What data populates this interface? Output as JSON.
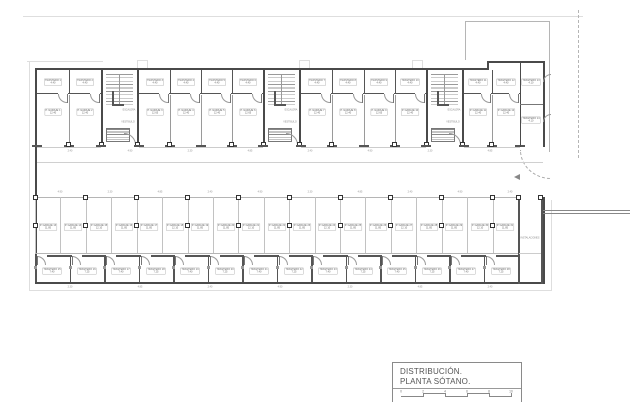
{
  "title_block": {
    "line1": "DISTRIBUCIÓN.",
    "line2": "PLANTA SÓTANO.",
    "scale_ticks": [
      "0",
      "2",
      "4",
      "6",
      "8",
      "10"
    ]
  },
  "core_labels": {
    "escalera": "ESCALERA",
    "vestibulo": "VESTIBULO"
  },
  "instalaciones_label": "INSTALACIONES",
  "rooms": {
    "top_trasteros": [
      {
        "name": "TRASTERO 1",
        "area": "4.40"
      },
      {
        "name": "TRASTERO 2",
        "area": "4.40"
      },
      {
        "name": "TRASTERO 3",
        "area": "4.40"
      },
      {
        "name": "TRASTERO 4",
        "area": "4.40"
      },
      {
        "name": "TRASTERO 5",
        "area": "4.40"
      },
      {
        "name": "TRASTERO 6",
        "area": "4.40"
      },
      {
        "name": "TRASTERO 7",
        "area": "4.40"
      },
      {
        "name": "TRASTERO 8",
        "area": "4.40"
      },
      {
        "name": "TRASTERO 9",
        "area": "4.40"
      },
      {
        "name": "TRASTERO 10",
        "area": "4.40"
      },
      {
        "name": "TRASTERO 11",
        "area": "4.40"
      },
      {
        "name": "TRASTERO 12",
        "area": "4.40"
      }
    ],
    "top_garajes": [
      {
        "name": "P. GARAJE 1",
        "area": "12.40"
      },
      {
        "name": "P. GARAJE 2",
        "area": "12.40"
      },
      {
        "name": "P. GARAJE 3",
        "area": "12.65"
      },
      {
        "name": "P. GARAJE 4",
        "area": "12.40"
      },
      {
        "name": "P. GARAJE 5",
        "area": "12.40"
      },
      {
        "name": "P. GARAJE 6",
        "area": "12.65"
      },
      {
        "name": "P. GARAJE 7",
        "area": "12.40"
      },
      {
        "name": "P. GARAJE 8",
        "area": "12.40"
      },
      {
        "name": "P. GARAJE 9",
        "area": "12.65"
      },
      {
        "name": "P. GARAJE 10",
        "area": "12.40"
      },
      {
        "name": "P. GARAJE 11",
        "area": "12.40"
      },
      {
        "name": "P. GARAJE 12",
        "area": "12.40"
      }
    ],
    "side_trasteros": [
      {
        "name": "TRASTERO 13",
        "area": "4.10"
      },
      {
        "name": "TRASTERO 14",
        "area": "4.10"
      }
    ],
    "parking": [
      {
        "name": "P. GARAJE 13",
        "area": "11.85"
      },
      {
        "name": "P. GARAJE 14",
        "area": "11.85"
      },
      {
        "name": "P. GARAJE 15",
        "area": "12.10"
      },
      {
        "name": "P. GARAJE 16",
        "area": "11.85"
      },
      {
        "name": "P. GARAJE 17",
        "area": "11.85"
      },
      {
        "name": "P. GARAJE 18",
        "area": "12.10"
      },
      {
        "name": "P. GARAJE 19",
        "area": "11.85"
      },
      {
        "name": "P. GARAJE 20",
        "area": "11.85"
      },
      {
        "name": "P. GARAJE 21",
        "area": "12.10"
      },
      {
        "name": "P. GARAJE 22",
        "area": "11.85"
      },
      {
        "name": "P. GARAJE 23",
        "area": "11.85"
      },
      {
        "name": "P. GARAJE 24",
        "area": "12.10"
      },
      {
        "name": "P. GARAJE 25",
        "area": "11.85"
      },
      {
        "name": "P. GARAJE 26",
        "area": "11.85"
      },
      {
        "name": "P. GARAJE 27",
        "area": "12.10"
      },
      {
        "name": "P. GARAJE 28",
        "area": "11.85"
      },
      {
        "name": "P. GARAJE 29",
        "area": "11.85"
      },
      {
        "name": "P. GARAJE 30",
        "area": "12.10"
      },
      {
        "name": "P. GARAJE 31",
        "area": "11.85"
      }
    ],
    "bottom_trasteros": [
      {
        "name": "TRASTERO 15",
        "area": "7.40"
      },
      {
        "name": "TRASTERO 16",
        "area": "7.25"
      },
      {
        "name": "TRASTERO 17",
        "area": "7.40"
      },
      {
        "name": "TRASTERO 18",
        "area": "7.25"
      },
      {
        "name": "TRASTERO 19",
        "area": "7.40"
      },
      {
        "name": "TRASTERO 20",
        "area": "7.25"
      },
      {
        "name": "TRASTERO 21",
        "area": "7.40"
      },
      {
        "name": "TRASTERO 22",
        "area": "7.25"
      },
      {
        "name": "TRASTERO 23",
        "area": "7.40"
      },
      {
        "name": "TRASTERO 24",
        "area": "7.25"
      },
      {
        "name": "TRASTERO 25",
        "area": "7.40"
      },
      {
        "name": "TRASTERO 26",
        "area": "7.25"
      },
      {
        "name": "TRASTERO 27",
        "area": "7.40"
      },
      {
        "name": "TRASTERO 28",
        "area": "7.25"
      }
    ]
  },
  "dims": [
    "2.40",
    "4.90",
    "2.30",
    "4.85",
    "2.40",
    "4.90",
    "2.30",
    "4.85",
    "2.40",
    "4.90"
  ],
  "colors": {
    "wall": "#4a4a4a",
    "light": "#b5b5b5",
    "faint": "#dedede",
    "text": "#666666"
  }
}
